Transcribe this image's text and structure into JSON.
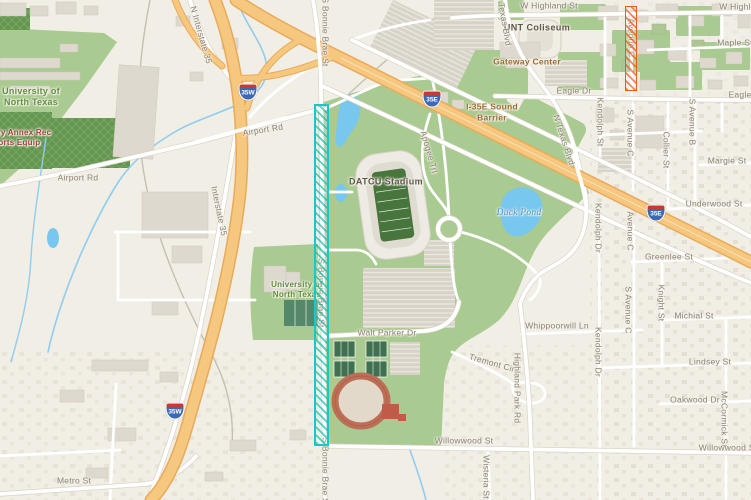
{
  "map": {
    "colors": {
      "land": "#f1eee6",
      "campus_green": "#a9ca90",
      "water_blue": "#78c7ee",
      "highway_orange": "#f6c77e",
      "road_white": "#ffffff",
      "teal_overlay": "#17c9c4",
      "orange_overlay": "#e2601c",
      "shield_blue": "#3c69b0",
      "shield_red": "#c43c31"
    },
    "labels": [
      {
        "text": "W Highland St",
        "x": 549,
        "y": 6,
        "style": "street"
      },
      {
        "text": "W Highland St",
        "x": 748,
        "y": 7,
        "style": "street"
      },
      {
        "text": "Maple St",
        "x": 735,
        "y": 43,
        "style": "street"
      },
      {
        "text": "UNT Coliseum",
        "x": 537,
        "y": 28,
        "style": "poi2"
      },
      {
        "text": "Gateway Center",
        "x": 527,
        "y": 62,
        "style": "poi"
      },
      {
        "text": "Eagle Dr",
        "x": 574,
        "y": 91,
        "style": "street"
      },
      {
        "text": "Eagle Dr",
        "x": 746,
        "y": 95,
        "style": "street"
      },
      {
        "text": "I-35E Sound\nBarrier",
        "x": 492,
        "y": 112,
        "style": "poi"
      },
      {
        "text": "N Texas Blvd",
        "x": 504,
        "y": 20,
        "rot": 80,
        "style": "street"
      },
      {
        "text": "N Texas Blvd",
        "x": 564,
        "y": 140,
        "rot": 72,
        "style": "street"
      },
      {
        "text": "Kendolph St",
        "x": 600,
        "y": 122,
        "rot": 90,
        "style": "street"
      },
      {
        "text": "S Avenue C",
        "x": 630,
        "y": 133,
        "rot": 90,
        "style": "street"
      },
      {
        "text": "Collier St",
        "x": 666,
        "y": 150,
        "rot": 90,
        "style": "street"
      },
      {
        "text": "S Avenue B",
        "x": 692,
        "y": 122,
        "rot": 90,
        "style": "street"
      },
      {
        "text": "Margie St",
        "x": 727,
        "y": 161,
        "style": "street"
      },
      {
        "text": "Underwood St",
        "x": 714,
        "y": 204,
        "style": "street"
      },
      {
        "text": "Avenue C",
        "x": 630,
        "y": 231,
        "rot": 90,
        "style": "street"
      },
      {
        "text": "Kendolph Dr",
        "x": 598,
        "y": 228,
        "rot": 90,
        "style": "street"
      },
      {
        "text": "Greenlee St",
        "x": 669,
        "y": 257,
        "style": "street"
      },
      {
        "text": "S Avenue C",
        "x": 628,
        "y": 310,
        "rot": 90,
        "style": "street"
      },
      {
        "text": "Knight St",
        "x": 661,
        "y": 303,
        "rot": 90,
        "style": "street"
      },
      {
        "text": "Michial St",
        "x": 694,
        "y": 316,
        "style": "street"
      },
      {
        "text": "Whippoorwill Ln",
        "x": 557,
        "y": 326,
        "style": "street"
      },
      {
        "text": "Kendolph Dr",
        "x": 598,
        "y": 352,
        "rot": 90,
        "style": "street"
      },
      {
        "text": "Lindsey St",
        "x": 710,
        "y": 362,
        "style": "street"
      },
      {
        "text": "Tremont Cir",
        "x": 492,
        "y": 363,
        "rot": 16,
        "style": "street"
      },
      {
        "text": "Highland Park Rd",
        "x": 517,
        "y": 388,
        "rot": 90,
        "style": "street"
      },
      {
        "text": "Oakwood Dr",
        "x": 695,
        "y": 400,
        "style": "street"
      },
      {
        "text": "McCormick St",
        "x": 724,
        "y": 419,
        "rot": 90,
        "style": "street"
      },
      {
        "text": "Willowwood St",
        "x": 464,
        "y": 441,
        "style": "street"
      },
      {
        "text": "Willowwood St",
        "x": 728,
        "y": 448,
        "style": "street"
      },
      {
        "text": "Wisteria St",
        "x": 486,
        "y": 477,
        "rot": 90,
        "style": "street"
      },
      {
        "text": "Walt Parker Dr",
        "x": 387,
        "y": 333,
        "style": "street"
      },
      {
        "text": "Metro St",
        "x": 74,
        "y": 481,
        "style": "street"
      },
      {
        "text": "Airport Rd",
        "x": 78,
        "y": 178,
        "style": "street"
      },
      {
        "text": "Airport Rd",
        "x": 263,
        "y": 130,
        "rot": -9,
        "style": "street"
      },
      {
        "text": "Interstate 35",
        "x": 219,
        "y": 211,
        "rot": 78,
        "style": "street"
      },
      {
        "text": "N Interstate 35",
        "x": 201,
        "y": 35,
        "rot": 74,
        "style": "street"
      },
      {
        "text": "S Bonnie Brae St",
        "x": 325,
        "y": 32,
        "rot": 90,
        "style": "street"
      },
      {
        "text": "S Bonnie Brae St",
        "x": 321,
        "y": 293,
        "rot": 90,
        "style": "under"
      },
      {
        "text": "S Bonnie Brae St",
        "x": 325,
        "y": 472,
        "rot": 90,
        "style": "street"
      },
      {
        "text": "Avenue C",
        "x": 631,
        "y": 38,
        "rot": 90,
        "style": "under"
      },
      {
        "text": "Apogee Trl",
        "x": 429,
        "y": 152,
        "rot": 74,
        "style": "street"
      },
      {
        "text": "University of\nNorth Texas",
        "x": 31,
        "y": 97,
        "style": "campus"
      },
      {
        "text": "University of\nNorth Texas",
        "x": 297,
        "y": 290,
        "style": "campus2"
      },
      {
        "text": "Library Annex Rec\nSports Equip",
        "x": 14,
        "y": 138,
        "style": "warn"
      },
      {
        "text": "DATCU Stadium",
        "x": 386,
        "y": 182,
        "style": "poi2"
      },
      {
        "text": "Duck Pond",
        "x": 519,
        "y": 214,
        "style": "water"
      }
    ],
    "shields": [
      {
        "text": "35W",
        "x": 248,
        "y": 92
      },
      {
        "text": "35E",
        "x": 432,
        "y": 99
      },
      {
        "text": "35E",
        "x": 656,
        "y": 213
      },
      {
        "text": "35W",
        "x": 175,
        "y": 411
      }
    ],
    "overlays": [
      {
        "name": "highlight-corridor-teal",
        "x": 314,
        "y": 104,
        "width": 15,
        "height": 342,
        "color": "#17c9c4",
        "hatch": "rgba(23,190,185,0.72)",
        "border": 2
      },
      {
        "name": "highlight-segment-orange",
        "x": 625,
        "y": 6,
        "width": 12,
        "height": 85,
        "color": "#e2601c",
        "hatch": "rgba(235,95,35,0.72)",
        "border": 1.5
      }
    ]
  }
}
